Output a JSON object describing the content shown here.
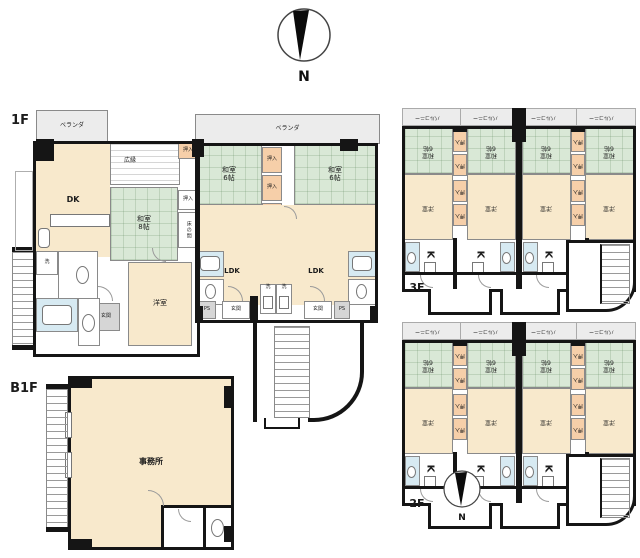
{
  "compass": {
    "n": "N"
  },
  "palette": {
    "wall": "#151515",
    "room_cream": "#F8E9CC",
    "tatami_green": "#D9E8D6",
    "closet_orange": "#F6CFA9",
    "balcony_gray": "#ECECEC",
    "entrance_gray": "#D6D6D6",
    "bath_blue": "#D7EAF2"
  },
  "floor1": {
    "label": "1F",
    "veranda": "ベランダ",
    "dk": "DK",
    "hiroen": "広縁",
    "oshiire": "押入",
    "monoire": "物入",
    "washitsu8": "和室\n8帖",
    "washitsu6": "和室\n6帖",
    "tokonoma": "床の間",
    "ldk": "LDK",
    "yoshitsu": "洋室",
    "genkan": "玄関",
    "ps": "PS",
    "sen": "洗"
  },
  "b1f": {
    "label": "B1F",
    "office": "事務所"
  },
  "upper": {
    "f3_label": "3F",
    "f2_label": "2F",
    "balcony": "バルコニー",
    "washitsu": "和室\n6帖",
    "yoshitsu": "洋室",
    "oshiire": "押入",
    "k": "K"
  }
}
